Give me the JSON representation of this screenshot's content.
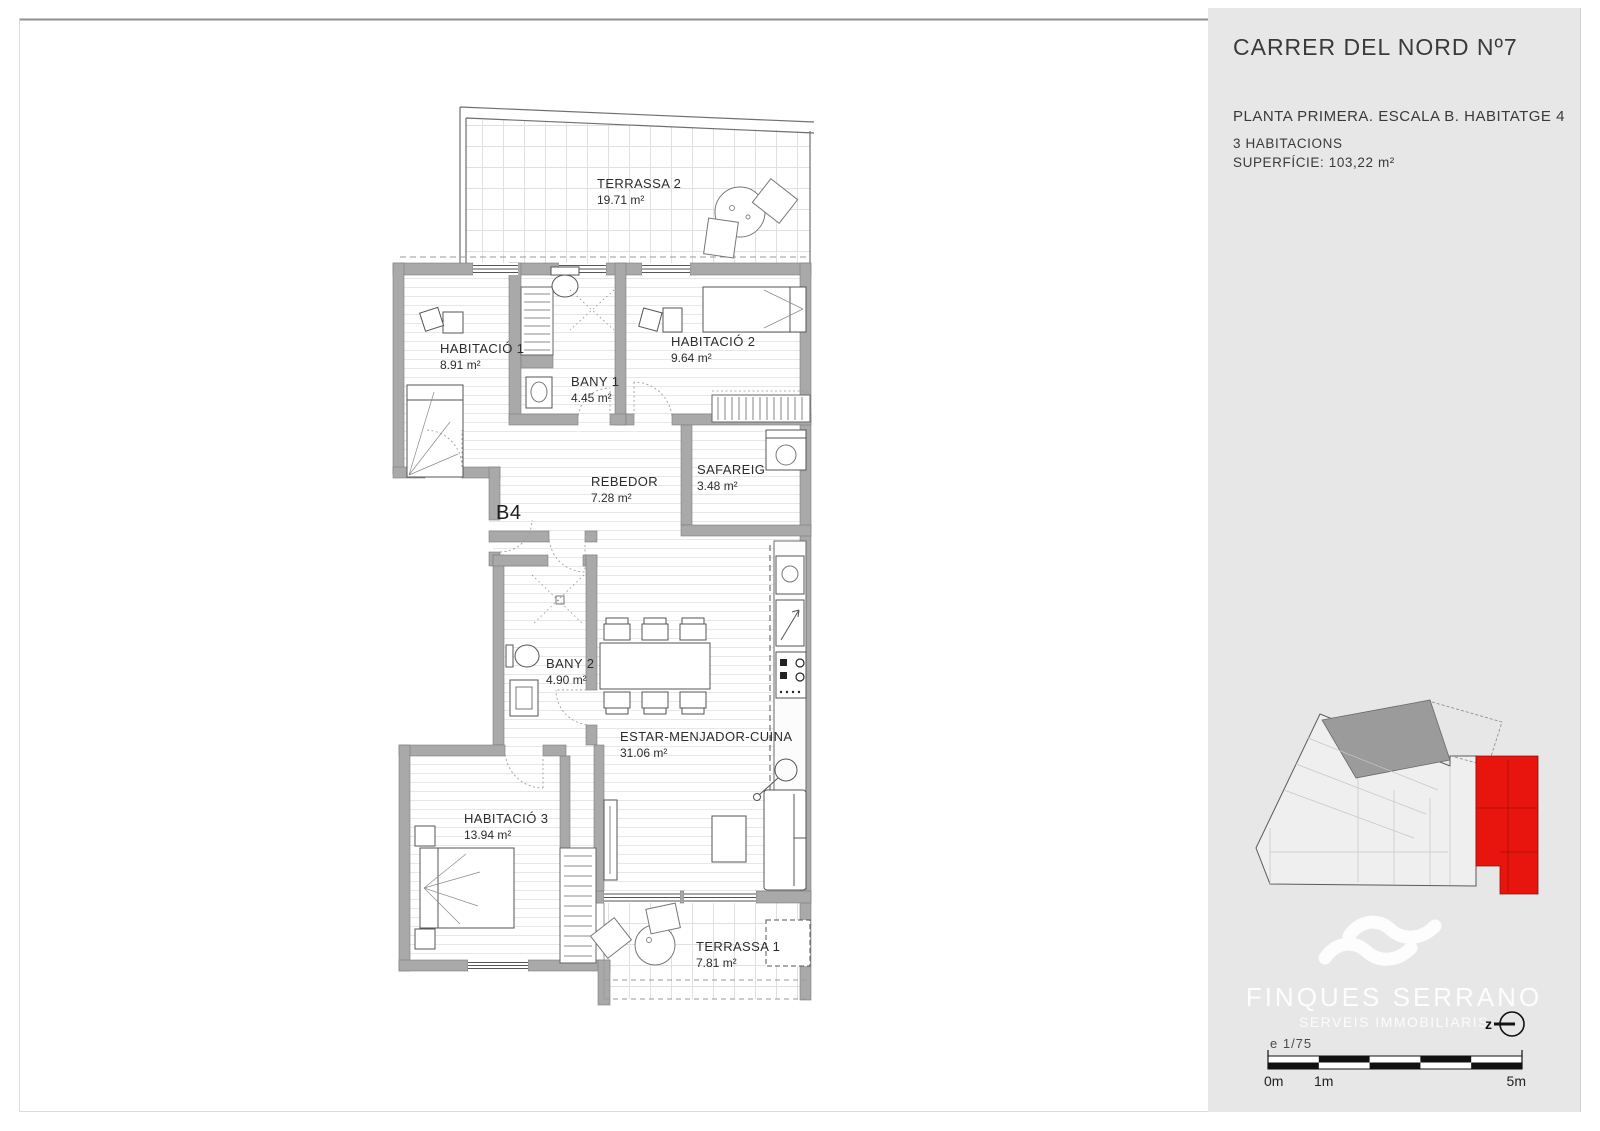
{
  "sidebar": {
    "title": "CARRER DEL NORD Nº7",
    "subtitle": "PLANTA PRIMERA. ESCALA B. HABITATGE 4",
    "rooms_line": "3 HABITACIONS",
    "surface_line": "SUPERFÍCIE: 103,22 m²",
    "brand_name": "FINQUES SERRANO",
    "brand_tagline": "SERVEIS IMMOBILIARIS",
    "north_label": "z",
    "scale_label": "e 1/75",
    "scale_ticks": [
      "0m",
      "1m",
      "5m"
    ],
    "highlight_color": "#e8140e",
    "background_color": "#e7e7e8"
  },
  "plan": {
    "unit_label": "B4",
    "rooms": [
      {
        "name": "TERRASSA 2",
        "area": "19.71 m²"
      },
      {
        "name": "HABITACIÓ 1",
        "area": "8.91 m²"
      },
      {
        "name": "BANY 1",
        "area": "4.45 m²"
      },
      {
        "name": "HABITACIÓ 2",
        "area": "9.64 m²"
      },
      {
        "name": "REBEDOR",
        "area": "7.28 m²"
      },
      {
        "name": "SAFAREIG",
        "area": "3.48 m²"
      },
      {
        "name": "BANY 2",
        "area": "4.90 m²"
      },
      {
        "name": "ESTAR-MENJADOR-CUINA",
        "area": "31.06 m²"
      },
      {
        "name": "HABITACIÓ 3",
        "area": "13.94 m²"
      },
      {
        "name": "TERRASSA 1",
        "area": "7.81 m²"
      }
    ]
  }
}
